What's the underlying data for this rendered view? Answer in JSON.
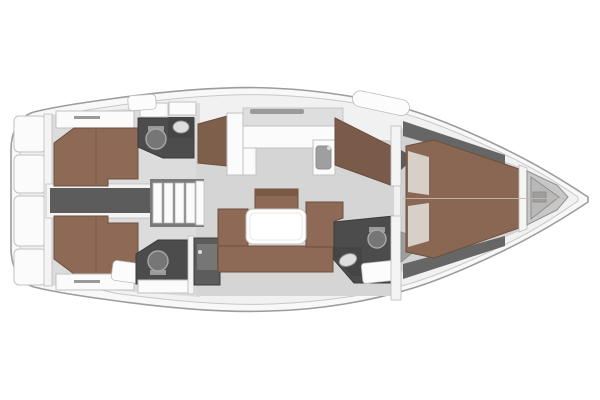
{
  "vessel": {
    "type": "sailing-yacht-interior-floor-plan",
    "orientation": "bow-right",
    "areas": [
      "swim-platform",
      "aft-cabin-port",
      "aft-cabin-starboard",
      "aft-head-port",
      "aft-head-starboard",
      "engine-corridor",
      "companionway-steps",
      "galley",
      "salon",
      "nav-station",
      "forward-head",
      "owner-cabin",
      "anchor-locker"
    ]
  },
  "palette": {
    "background": "#ffffff",
    "hull": "#f8f8f8",
    "deck": "#f1f1f1",
    "floor_salon": "#d5d5d5",
    "floor_cabin": "#dcdcdc",
    "floor_owner": "#d2d2d2",
    "wood_berth": "#8e6a56",
    "wood_berth_fwd": "#8a6753",
    "wood_seat_back": "#7a5a47",
    "wood_wardrobe": "#7d5f4c",
    "wood_nav": "#7a5b49",
    "head_floor": "#4c4c4c",
    "head_counter": "#454545",
    "fixture_gray": "#767676",
    "fixture_light": "#dedede",
    "corridor": "#5c5c5c",
    "steps_back": "#7a7a7a",
    "furniture_white": "#fbfbfb",
    "table_white": "#ffffff",
    "locker_gray": "#c7c7c7",
    "locker_inner": "#b8b8b8",
    "shelf_dark": "#666666",
    "pillow": "#d7d0c9",
    "seat_gray": "#9e9e9e",
    "slot_gray": "#9a9a9a",
    "hatch_white": "#fcfcfc",
    "wall_white": "#f4f4f4",
    "shadow": "#e0e0e0",
    "centerline": "#c2b9b1",
    "sink_gray": "#9f9f9f"
  }
}
